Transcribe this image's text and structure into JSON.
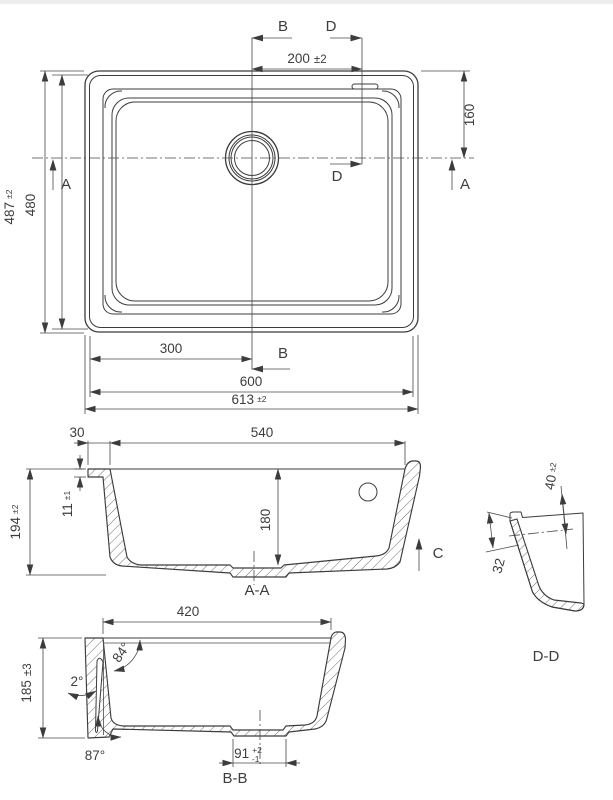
{
  "colors": {
    "background": "#ffffff",
    "lines": "#3c3c3c",
    "text": "#3d3d3d",
    "top_edge": "#ededed"
  },
  "top_view": {
    "section_a_label": "A",
    "section_b_label": "B",
    "section_d_label": "D",
    "dim_spout_offset": {
      "v": "200",
      "t": "±2"
    },
    "dim_overflow": "160",
    "dim_outer_height": {
      "v": "487",
      "t": "±2"
    },
    "dim_inner_height": "480",
    "dim_center": "300",
    "dim_inner_width": "600",
    "dim_outer_width": {
      "v": "613",
      "t": "±2"
    }
  },
  "section_aa": {
    "label": "A-A",
    "section_c_label": "C",
    "dim_rim_width": "30",
    "dim_bowl_width": "540",
    "dim_rim_height": {
      "v": "11",
      "t": "±1"
    },
    "dim_total_depth": {
      "v": "194",
      "t": "±2"
    },
    "dim_bowl_depth": "180"
  },
  "detail_dd": {
    "label": "D-D",
    "dim_overflow_width": {
      "v": "40",
      "t": "±2"
    },
    "dim_overflow_drop": "32"
  },
  "section_bb": {
    "label": "B-B",
    "dim_bowl_length": "420",
    "dim_total_depth": {
      "v": "185",
      "t": "±3"
    },
    "angle_wall": "84°",
    "angle_draft": "2°",
    "angle_bottom": "87°",
    "dim_drain": {
      "v": "91",
      "tp": "+2",
      "tm": "-1"
    }
  }
}
